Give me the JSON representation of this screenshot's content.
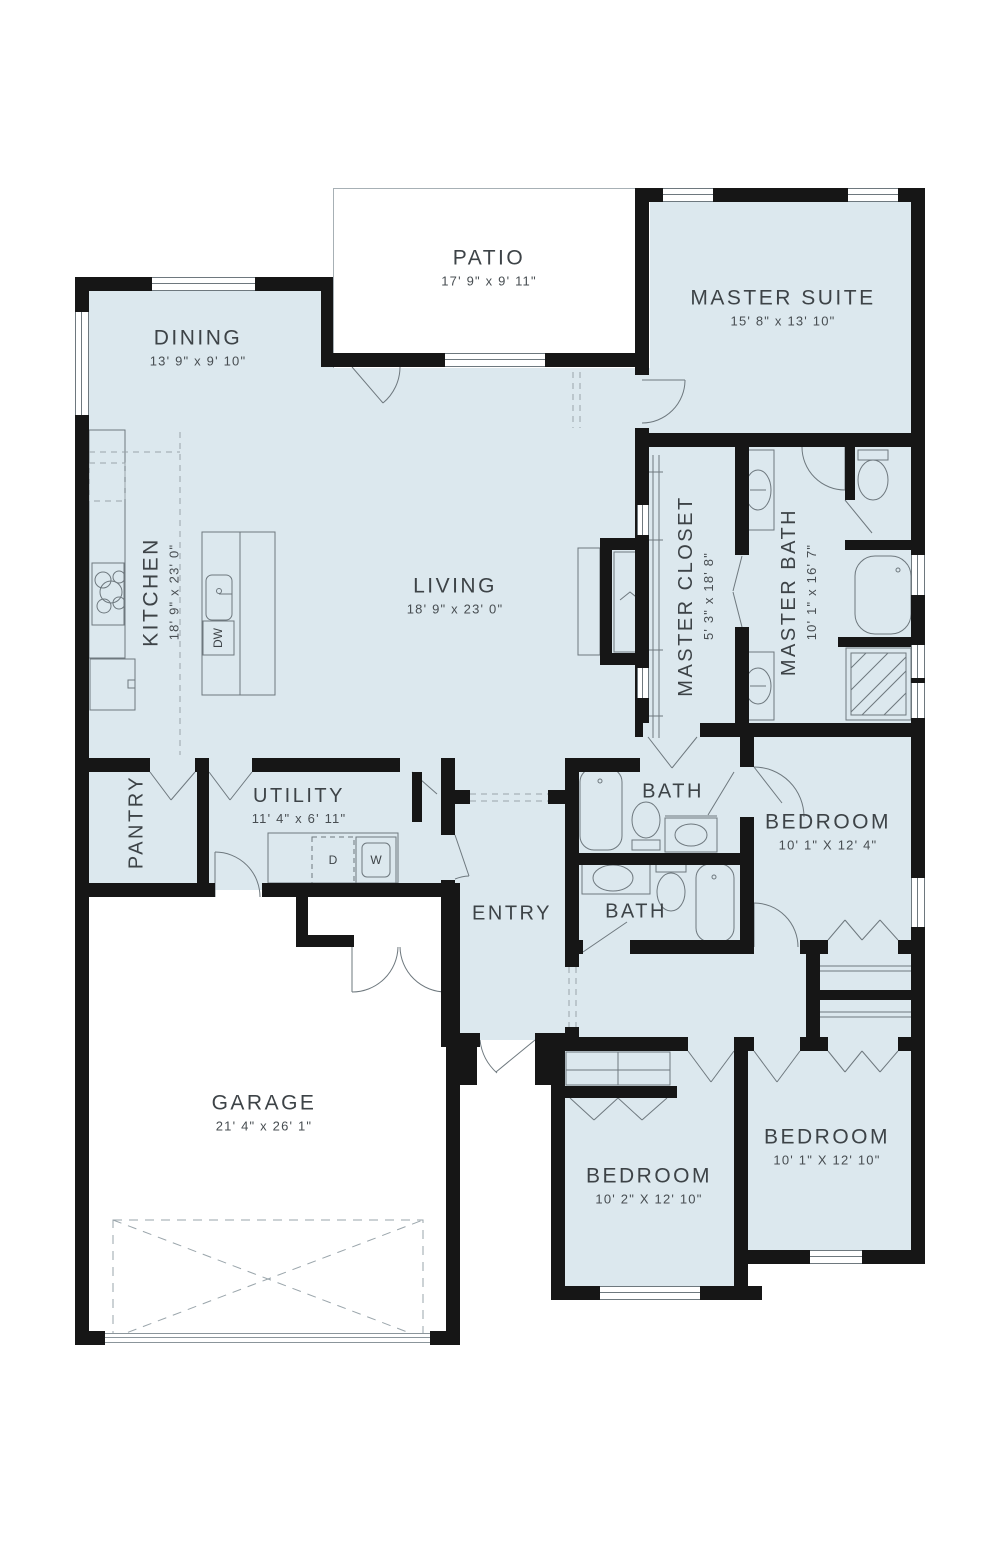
{
  "rooms": [
    {
      "id": "patio",
      "name": "PATIO",
      "dims": "17' 9\" x 9' 11\""
    },
    {
      "id": "master_suite",
      "name": "MASTER SUITE",
      "dims": "15' 8\" x 13' 10\""
    },
    {
      "id": "dining",
      "name": "DINING",
      "dims": "13' 9\" x 9' 10\""
    },
    {
      "id": "kitchen",
      "name": "KITCHEN",
      "dims": "18' 9\" x 23' 0\""
    },
    {
      "id": "living",
      "name": "LIVING",
      "dims": "18' 9\" x 23' 0\""
    },
    {
      "id": "master_closet",
      "name": "MASTER CLOSET",
      "dims": "5' 3\" x 18' 8\""
    },
    {
      "id": "master_bath",
      "name": "MASTER BATH",
      "dims": "10' 1\" x 16' 7\""
    },
    {
      "id": "pantry",
      "name": "PANTRY",
      "dims": ""
    },
    {
      "id": "utility",
      "name": "UTILITY",
      "dims": "11' 4\" x 6' 11\""
    },
    {
      "id": "bath_top",
      "name": "BATH",
      "dims": ""
    },
    {
      "id": "bath_bottom",
      "name": "BATH",
      "dims": ""
    },
    {
      "id": "entry",
      "name": "ENTRY",
      "dims": ""
    },
    {
      "id": "bedroom_right",
      "name": "BEDROOM",
      "dims": "10' 1\" X 12' 4\""
    },
    {
      "id": "garage",
      "name": "GARAGE",
      "dims": "21' 4\" x 26' 1\""
    },
    {
      "id": "bedroom_mid",
      "name": "BEDROOM",
      "dims": "10' 2\" X 12' 10\""
    },
    {
      "id": "bedroom_bottom_right",
      "name": "BEDROOM",
      "dims": "10' 1\" X 12' 10\""
    }
  ],
  "appliances": {
    "dishwasher": "DW",
    "dryer": "D",
    "washer": "W"
  },
  "colors": {
    "room_fill": "#dce8ee",
    "wall": "#161616",
    "fixture_line": "#6e787e",
    "text": "#3d4347"
  }
}
